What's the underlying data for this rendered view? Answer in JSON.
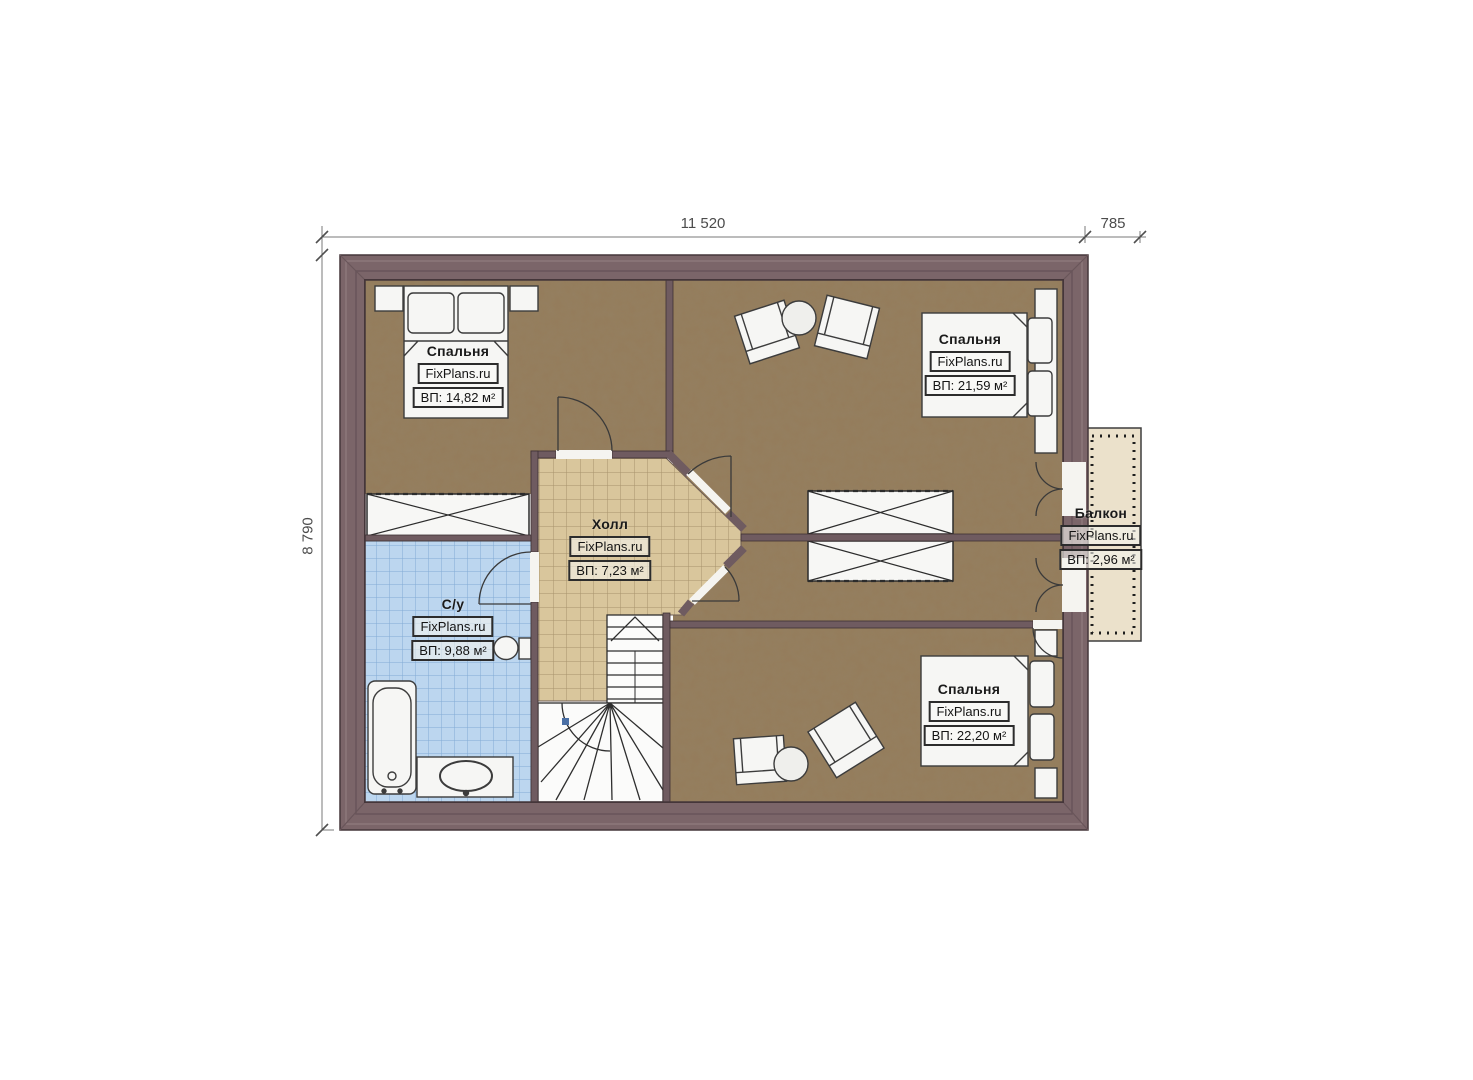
{
  "branding": {
    "label": "FixPlans.ru"
  },
  "dimensions": {
    "width_main": "11 520",
    "width_balcony": "785",
    "height_left": "8 790"
  },
  "rooms": {
    "bedroom_tl": {
      "name": "Спальня",
      "area": "ВП: 14,82 м²"
    },
    "bedroom_tr": {
      "name": "Спальня",
      "area": "ВП: 21,59 м²"
    },
    "hall": {
      "name": "Холл",
      "area": "ВП: 7,23 м²"
    },
    "bathroom": {
      "name": "С/у",
      "area": "ВП: 9,88 м²"
    },
    "bedroom_br": {
      "name": "Спальня",
      "area": "ВП: 22,20 м²"
    },
    "balcony": {
      "name": "Балкон",
      "area": "ВП: 2,96 м²"
    }
  },
  "colors": {
    "wall": "#7b6569",
    "floor_wood": "#8d7556",
    "hall_tile": "#d9c69c",
    "bath_tile": "#bcd6ef",
    "balcony_floor": "#ebe1cb"
  }
}
